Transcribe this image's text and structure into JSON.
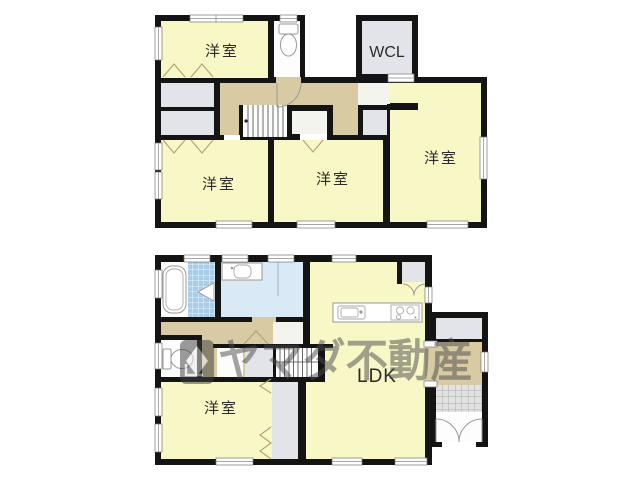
{
  "watermark": {
    "text": "ヤマダ不動産",
    "logo_icon": "yamada-logo"
  },
  "floors": [
    {
      "name": "upper-floor",
      "rooms": [
        {
          "label": "洋室"
        },
        {
          "label": "WCL"
        },
        {
          "label": "洋室"
        },
        {
          "label": "洋室"
        },
        {
          "label": "洋室"
        }
      ],
      "fixtures": [
        "toilet",
        "stairs",
        "closets"
      ]
    },
    {
      "name": "lower-floor",
      "rooms": [
        {
          "label": "洋室"
        },
        {
          "label": "LDK"
        }
      ],
      "fixtures": [
        "bathtub",
        "vanity-sink",
        "toilet",
        "kitchen-sink",
        "stove",
        "stairs",
        "entrance-doors",
        "shoe-closet"
      ]
    }
  ],
  "colors": {
    "walls": "#141414",
    "room_yellow": "#F8F7C6",
    "hall_tan": "#D8CBA3",
    "closet_gray": "#E3E3EA",
    "washroom_blue": "#D9E9F5",
    "bath_tile_blue": "#A9CDE9",
    "entrance_tile": "#E2E2E2",
    "fold_mark": "#B5A478",
    "watermark_gray": "#4A4A4A"
  }
}
